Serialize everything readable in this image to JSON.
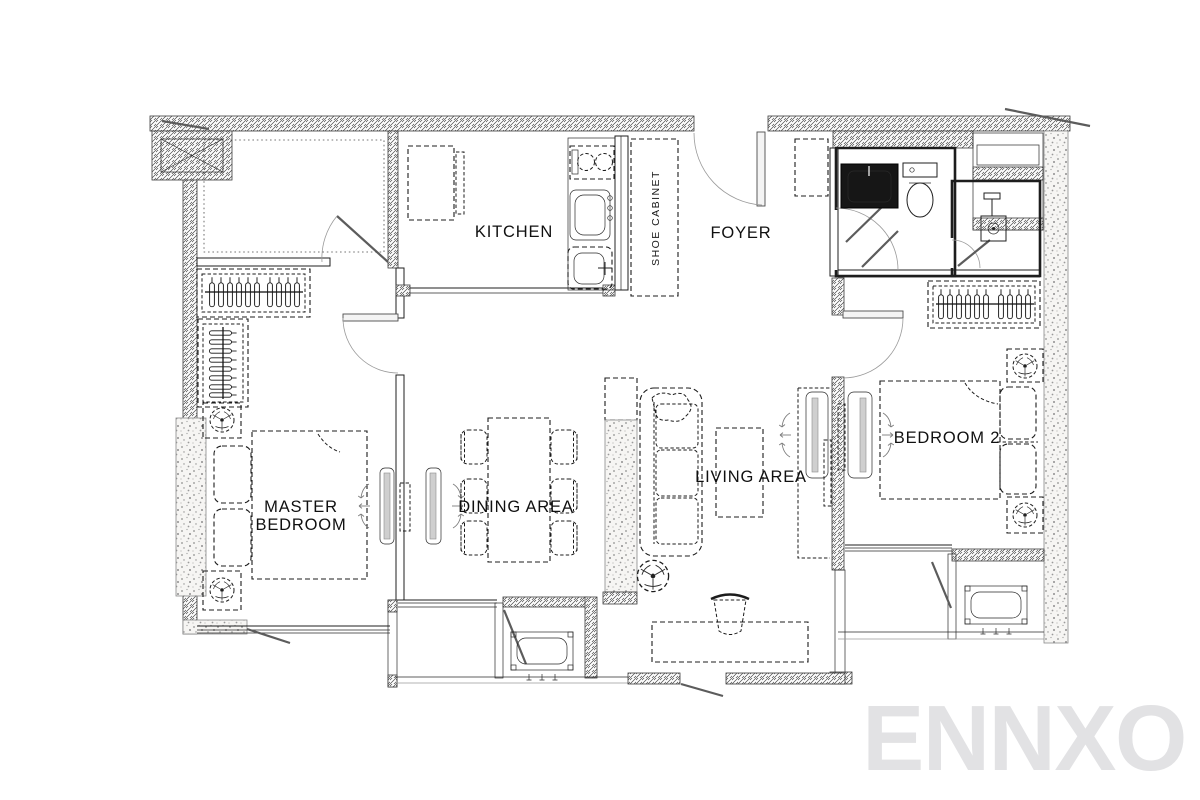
{
  "plan": {
    "type": "apartment-floor-plan",
    "rooms": [
      {
        "id": "kitchen",
        "label": "KITCHEN"
      },
      {
        "id": "foyer",
        "label": "FOYER"
      },
      {
        "id": "shoe-cabinet",
        "label": "SHOE CABINET"
      },
      {
        "id": "master-bedroom",
        "label": "MASTER BEDROOM",
        "lines": [
          "MASTER",
          "BEDROOM"
        ]
      },
      {
        "id": "dining-area",
        "label": "DINING AREA"
      },
      {
        "id": "living-area",
        "label": "LIVING AREA"
      },
      {
        "id": "bedroom-2",
        "label": "BEDROOM 2"
      }
    ],
    "watermark": "ENNXO",
    "colors": {
      "line": "#1f1f1f",
      "wall_hatch": "#4a4a4a",
      "column_speckle": "#8f8f8f",
      "column_fill": "#f6f5f3",
      "furniture_gray": "#cfcfcf",
      "watermark": "#e2e2e4",
      "background": "#ffffff"
    },
    "symbols": [
      "elevator-shaft",
      "concrete-column",
      "door-swing",
      "window-leaf",
      "clothes-hanger",
      "wardrobe-rail",
      "bed",
      "pillow",
      "table-lamp",
      "ceiling-fan",
      "sofa",
      "plant",
      "coffee-table",
      "dining-table",
      "dining-chair",
      "desk",
      "desk-chair",
      "tv-unit",
      "air-flow-arrows",
      "ac-condenser-unit",
      "stove-cooktop",
      "kitchen-sink",
      "vanity-sink",
      "toilet",
      "shower-head",
      "shower-tray"
    ]
  }
}
